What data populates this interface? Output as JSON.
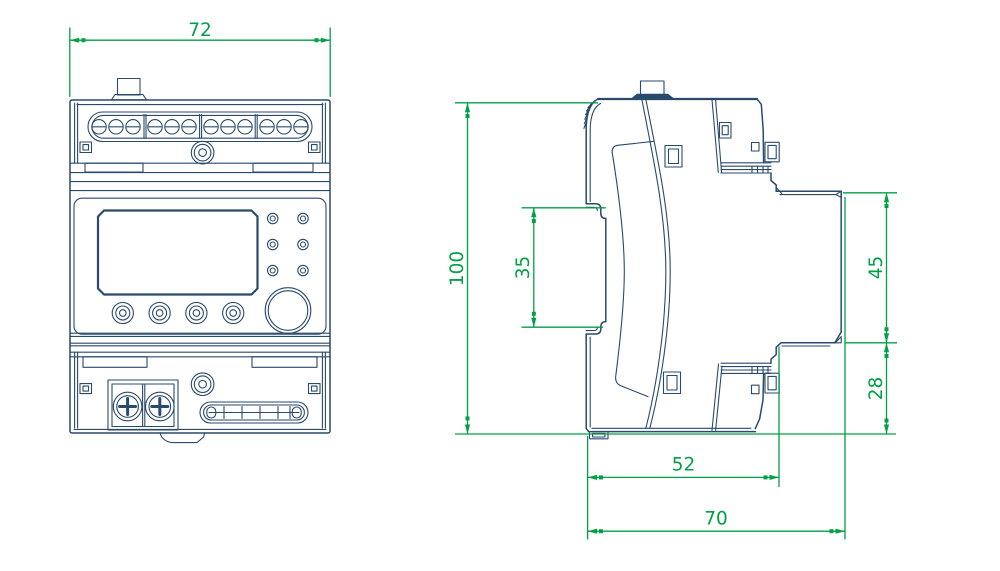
{
  "colors": {
    "outline": "#2a4a6c",
    "dimension": "#00a046",
    "background": "#ffffff"
  },
  "dimensions": {
    "front_width": "72",
    "overall_height": "100",
    "din_slot_height": "35",
    "upper_depth": "45",
    "lower_depth": "28",
    "body_depth": "52",
    "overall_depth": "70"
  }
}
